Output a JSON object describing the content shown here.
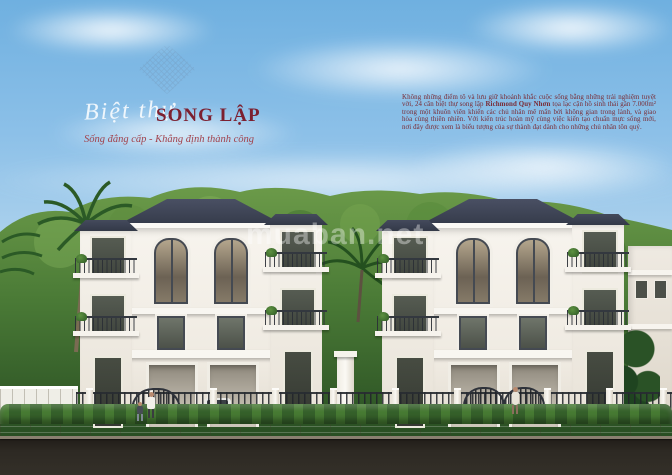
{
  "header": {
    "script_title": "Biệt thự",
    "main_title": "SONG LẬP",
    "subtitle": "Sống đẳng cấp - Khẳng định thành công"
  },
  "description": {
    "before_bold": "Không những điểm tô và lưu giữ khoảnh khắc cuộc sống bằng những trải nghiệm tuyệt vời, 24 căn biệt thự song lập ",
    "bold": "Richmond Quy Nhơn",
    "after_bold": " tọa lạc cận hồ sinh thái gần 7.000m² trong một khuôn viên khiến các chủ nhân mê mẩn bởi không gian trong lành, và giao hòa cùng thiên nhiên. Với kiến trúc hoàn mỹ cùng việc kiến tạo chuẩn mực sống mới, nơi đây được xem là biểu tượng của sự thành đạt dành cho những chủ nhân tôn quý."
  },
  "watermark": {
    "text": "muaban.net"
  },
  "colors": {
    "title": "#7c2030",
    "subtitle": "#a2424c",
    "paragraph": "#7a2a33",
    "roof": "#3d4250",
    "wall": "#f5f2ec",
    "sky_top": "#7cb6e2",
    "sky_bottom": "#cfe2f1",
    "foliage": "#46763a",
    "road": "#2b2825",
    "sidewalk": "#b4a893"
  }
}
